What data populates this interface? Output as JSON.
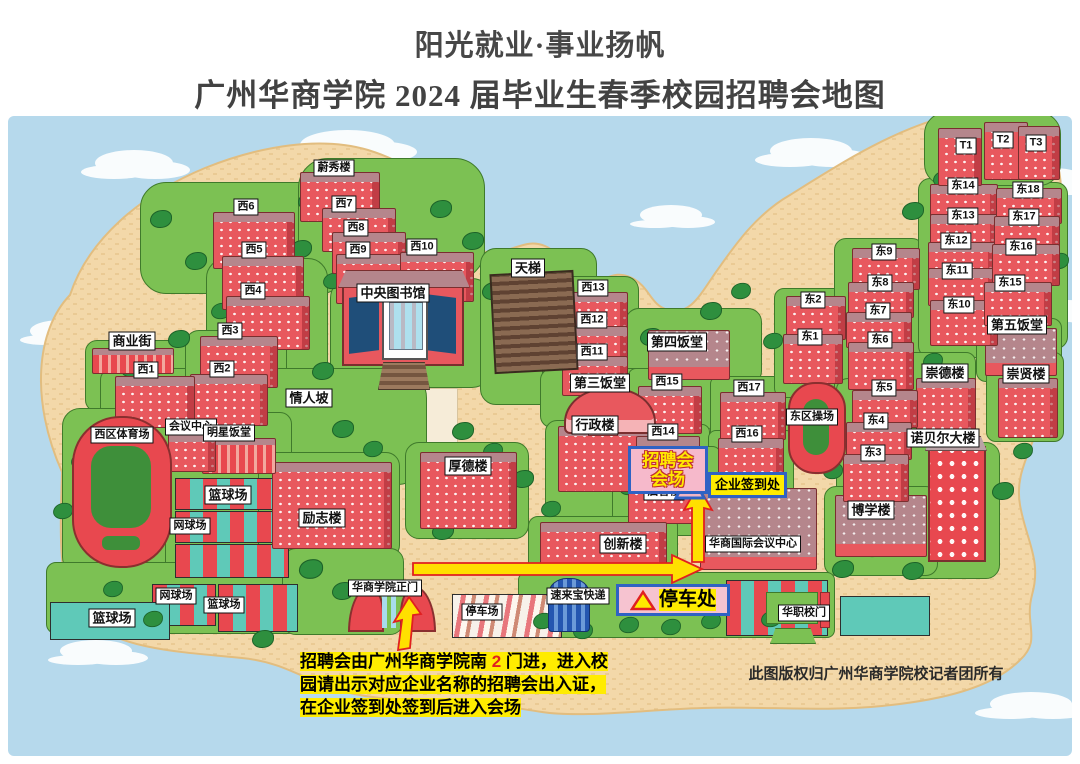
{
  "title": {
    "line1": "阳光就业·事业扬帆",
    "line2": "广州华商学院 2024 届毕业生春季校园招聘会地图"
  },
  "colors": {
    "sky_water": "#b6d9ec",
    "sand": "#f3d8a9",
    "sand_dash": "#e6c388",
    "green": "#7cc153",
    "tree": "#2e8f3e",
    "building_red": "#e8585e",
    "roof_mauve": "#b5868c",
    "court_teal": "#5fc9b8",
    "court_red": "#e8484f",
    "highlight_blue_border": "#2f62c4",
    "highlight_pink": "#f6b9cb",
    "highlight_yellow": "#ffec00",
    "arrow_yellow": "#ffe000",
    "arrow_red_outline": "#e02020"
  },
  "highlights": {
    "fair_venue": {
      "line1": "招聘会",
      "line2": "会场"
    },
    "sign_in": {
      "text": "企业签到处"
    },
    "parking": {
      "text": "停车处"
    }
  },
  "note": {
    "part1": "招聘会由广州华商学院南 ",
    "part2": "2",
    "part3": " 门进，进入校园请出示对应企业名称的招聘会出入证，在企业签到处签到后进入会场"
  },
  "copyright": "此图版权归广州华商学院校记者团所有",
  "map": {
    "labels": [
      {
        "t": "蔚秀楼",
        "x": 334,
        "y": 168
      },
      {
        "t": "西6",
        "x": 246,
        "y": 207
      },
      {
        "t": "西7",
        "x": 344,
        "y": 204
      },
      {
        "t": "西8",
        "x": 356,
        "y": 228
      },
      {
        "t": "西9",
        "x": 358,
        "y": 250
      },
      {
        "t": "西10",
        "x": 422,
        "y": 247
      },
      {
        "t": "西5",
        "x": 254,
        "y": 250
      },
      {
        "t": "西4",
        "x": 253,
        "y": 291
      },
      {
        "t": "西3",
        "x": 230,
        "y": 331
      },
      {
        "t": "西2",
        "x": 222,
        "y": 369
      },
      {
        "t": "西1",
        "x": 146,
        "y": 370
      },
      {
        "t": "商业街",
        "x": 132,
        "y": 341,
        "s": "md"
      },
      {
        "t": "中央图书馆",
        "x": 393,
        "y": 293,
        "s": "md"
      },
      {
        "t": "天梯",
        "x": 528,
        "y": 268,
        "s": "md"
      },
      {
        "t": "西13",
        "x": 593,
        "y": 288
      },
      {
        "t": "西12",
        "x": 592,
        "y": 320
      },
      {
        "t": "西11",
        "x": 592,
        "y": 352
      },
      {
        "t": "第四饭堂",
        "x": 677,
        "y": 342,
        "s": "md"
      },
      {
        "t": "第三饭堂",
        "x": 600,
        "y": 383,
        "s": "md"
      },
      {
        "t": "情人坡",
        "x": 309,
        "y": 398,
        "s": "md"
      },
      {
        "t": "西15",
        "x": 667,
        "y": 382
      },
      {
        "t": "西17",
        "x": 749,
        "y": 388
      },
      {
        "t": "西14",
        "x": 663,
        "y": 432
      },
      {
        "t": "西16",
        "x": 747,
        "y": 434
      },
      {
        "t": "东区操场",
        "x": 812,
        "y": 417
      },
      {
        "t": "会议中心",
        "x": 191,
        "y": 427
      },
      {
        "t": "明星饭堂",
        "x": 229,
        "y": 433
      },
      {
        "t": "西区体育场",
        "x": 122,
        "y": 435
      },
      {
        "t": "行政楼",
        "x": 595,
        "y": 425,
        "s": "md"
      },
      {
        "t": "厚德楼",
        "x": 468,
        "y": 466,
        "s": "md"
      },
      {
        "t": "启智楼",
        "x": 664,
        "y": 492
      },
      {
        "t": "励志楼",
        "x": 322,
        "y": 518,
        "s": "md"
      },
      {
        "t": "篮球场",
        "x": 228,
        "y": 495,
        "s": "md"
      },
      {
        "t": "网球场",
        "x": 190,
        "y": 526
      },
      {
        "t": "网球场",
        "x": 176,
        "y": 596
      },
      {
        "t": "篮球场",
        "x": 224,
        "y": 605
      },
      {
        "t": "篮球场",
        "x": 112,
        "y": 618,
        "s": "md"
      },
      {
        "t": "创新楼",
        "x": 623,
        "y": 544,
        "s": "md"
      },
      {
        "t": "华商国际会议中心",
        "x": 753,
        "y": 544
      },
      {
        "t": "华商学院正门",
        "x": 385,
        "y": 588
      },
      {
        "t": "停车场",
        "x": 482,
        "y": 612
      },
      {
        "t": "速来宝快递",
        "x": 578,
        "y": 596
      },
      {
        "t": "华职校门",
        "x": 804,
        "y": 613
      },
      {
        "t": "博学楼",
        "x": 871,
        "y": 510,
        "s": "md"
      },
      {
        "t": "诺贝尔大楼",
        "x": 943,
        "y": 438,
        "s": "md"
      },
      {
        "t": "崇德楼",
        "x": 945,
        "y": 373,
        "s": "md"
      },
      {
        "t": "崇贤楼",
        "x": 1026,
        "y": 374,
        "s": "md"
      },
      {
        "t": "第五饭堂",
        "x": 1017,
        "y": 325,
        "s": "md"
      },
      {
        "t": "东1",
        "x": 810,
        "y": 337
      },
      {
        "t": "东2",
        "x": 813,
        "y": 300
      },
      {
        "t": "东3",
        "x": 873,
        "y": 453
      },
      {
        "t": "东4",
        "x": 876,
        "y": 421
      },
      {
        "t": "东5",
        "x": 884,
        "y": 388
      },
      {
        "t": "东6",
        "x": 880,
        "y": 340
      },
      {
        "t": "东7",
        "x": 878,
        "y": 311
      },
      {
        "t": "东8",
        "x": 880,
        "y": 283
      },
      {
        "t": "东9",
        "x": 884,
        "y": 252
      },
      {
        "t": "东10",
        "x": 959,
        "y": 305
      },
      {
        "t": "东11",
        "x": 957,
        "y": 271
      },
      {
        "t": "东12",
        "x": 956,
        "y": 241
      },
      {
        "t": "东13",
        "x": 963,
        "y": 216
      },
      {
        "t": "东14",
        "x": 963,
        "y": 186
      },
      {
        "t": "东15",
        "x": 1010,
        "y": 283
      },
      {
        "t": "东16",
        "x": 1021,
        "y": 247
      },
      {
        "t": "东17",
        "x": 1024,
        "y": 217
      },
      {
        "t": "东18",
        "x": 1028,
        "y": 190
      },
      {
        "t": "T1",
        "x": 966,
        "y": 146
      },
      {
        "t": "T2",
        "x": 1003,
        "y": 140
      },
      {
        "t": "T3",
        "x": 1036,
        "y": 143
      }
    ],
    "clouds": [
      [
        95,
        150,
        78,
        26
      ],
      [
        300,
        130,
        95,
        30
      ],
      [
        640,
        205,
        62,
        20
      ],
      [
        770,
        138,
        82,
        26
      ],
      [
        1020,
        168,
        66,
        24
      ],
      [
        30,
        320,
        62,
        22
      ],
      [
        1042,
        300,
        52,
        20
      ],
      [
        60,
        640,
        72,
        22
      ],
      [
        990,
        692,
        82,
        24
      ]
    ],
    "greens": [
      [
        140,
        182,
        205,
        110,
        26
      ],
      [
        298,
        158,
        185,
        120,
        30
      ],
      [
        206,
        258,
        120,
        150,
        20
      ],
      [
        85,
        340,
        110,
        70,
        12
      ],
      [
        100,
        368,
        100,
        65,
        12
      ],
      [
        185,
        330,
        100,
        100,
        14
      ],
      [
        330,
        278,
        160,
        108,
        20
      ],
      [
        250,
        368,
        175,
        115,
        30
      ],
      [
        160,
        412,
        130,
        68,
        12
      ],
      [
        62,
        408,
        115,
        165,
        18
      ],
      [
        165,
        470,
        130,
        115,
        10
      ],
      [
        480,
        248,
        115,
        155,
        16
      ],
      [
        542,
        276,
        95,
        148,
        14
      ],
      [
        625,
        308,
        135,
        75,
        14
      ],
      [
        540,
        368,
        130,
        58,
        12
      ],
      [
        545,
        420,
        115,
        105,
        12
      ],
      [
        405,
        442,
        122,
        95,
        14
      ],
      [
        258,
        452,
        140,
        105,
        14
      ],
      [
        628,
        368,
        82,
        62,
        8
      ],
      [
        626,
        424,
        82,
        66,
        8
      ],
      [
        710,
        376,
        84,
        62,
        8
      ],
      [
        708,
        430,
        84,
        64,
        8
      ],
      [
        612,
        446,
        108,
        88,
        10
      ],
      [
        528,
        516,
        148,
        60,
        10
      ],
      [
        774,
        288,
        76,
        108,
        10
      ],
      [
        834,
        238,
        88,
        165,
        12
      ],
      [
        836,
        378,
        84,
        130,
        12
      ],
      [
        918,
        178,
        84,
        178,
        12
      ],
      [
        982,
        182,
        84,
        165,
        12
      ],
      [
        976,
        318,
        84,
        62,
        10
      ],
      [
        924,
        112,
        135,
        72,
        22
      ],
      [
        902,
        352,
        72,
        88,
        10
      ],
      [
        986,
        352,
        76,
        88,
        10
      ],
      [
        898,
        442,
        100,
        135,
        14
      ],
      [
        824,
        486,
        112,
        88,
        12
      ],
      [
        46,
        562,
        250,
        70,
        10
      ],
      [
        282,
        548,
        120,
        85,
        14
      ],
      [
        518,
        572,
        315,
        64,
        8
      ]
    ],
    "courts": [
      [
        175,
        478,
        112,
        30,
        "grid"
      ],
      [
        175,
        511,
        112,
        30,
        "grid"
      ],
      [
        175,
        544,
        112,
        32,
        "grid"
      ],
      [
        152,
        584,
        62,
        40,
        "grid"
      ],
      [
        218,
        584,
        78,
        46,
        "grid"
      ],
      [
        50,
        602,
        118,
        36,
        "teal"
      ],
      [
        452,
        594,
        108,
        42,
        "stripe"
      ],
      [
        726,
        580,
        100,
        54,
        "grid"
      ],
      [
        840,
        596,
        88,
        38,
        "teal"
      ]
    ],
    "buildings": [
      [
        300,
        172,
        78,
        48,
        "r"
      ],
      [
        322,
        208,
        72,
        42,
        "r"
      ],
      [
        332,
        232,
        72,
        40,
        "r"
      ],
      [
        336,
        254,
        76,
        48,
        "r"
      ],
      [
        400,
        252,
        72,
        48,
        "r"
      ],
      [
        213,
        212,
        80,
        55,
        "r"
      ],
      [
        222,
        256,
        80,
        52,
        "r"
      ],
      [
        226,
        296,
        82,
        52,
        "r"
      ],
      [
        200,
        336,
        76,
        50,
        "r"
      ],
      [
        190,
        374,
        76,
        50,
        "r"
      ],
      [
        115,
        376,
        78,
        50,
        "r"
      ],
      [
        92,
        348,
        80,
        24,
        "s"
      ],
      [
        562,
        292,
        64,
        40,
        "r"
      ],
      [
        562,
        326,
        64,
        36,
        "r"
      ],
      [
        562,
        356,
        64,
        38,
        "r"
      ],
      [
        648,
        330,
        80,
        48,
        "m"
      ],
      [
        558,
        426,
        90,
        64,
        "r"
      ],
      [
        638,
        386,
        62,
        46,
        "r"
      ],
      [
        720,
        392,
        64,
        46,
        "r"
      ],
      [
        636,
        436,
        62,
        48,
        "r"
      ],
      [
        718,
        438,
        64,
        48,
        "r"
      ],
      [
        628,
        476,
        84,
        46,
        "r"
      ],
      [
        420,
        452,
        95,
        75,
        "r"
      ],
      [
        272,
        462,
        118,
        85,
        "r"
      ],
      [
        540,
        522,
        125,
        46,
        "r"
      ],
      [
        700,
        488,
        115,
        80,
        "m"
      ],
      [
        835,
        495,
        90,
        60,
        "m"
      ],
      [
        916,
        378,
        58,
        58,
        "r"
      ],
      [
        998,
        378,
        58,
        58,
        "r"
      ],
      [
        985,
        328,
        70,
        46,
        "m"
      ],
      [
        786,
        296,
        58,
        42,
        "r"
      ],
      [
        783,
        334,
        58,
        48,
        "r"
      ],
      [
        852,
        248,
        66,
        40,
        "r"
      ],
      [
        848,
        282,
        64,
        34,
        "r"
      ],
      [
        846,
        312,
        64,
        34,
        "r"
      ],
      [
        848,
        342,
        64,
        46,
        "r"
      ],
      [
        852,
        390,
        64,
        36,
        "r"
      ],
      [
        846,
        422,
        64,
        36,
        "r"
      ],
      [
        843,
        454,
        64,
        46,
        "r"
      ],
      [
        930,
        184,
        66,
        36,
        "r"
      ],
      [
        930,
        214,
        66,
        32,
        "r"
      ],
      [
        928,
        242,
        66,
        32,
        "r"
      ],
      [
        928,
        268,
        66,
        36,
        "r"
      ],
      [
        930,
        300,
        66,
        44,
        "r"
      ],
      [
        996,
        188,
        64,
        34,
        "r"
      ],
      [
        994,
        216,
        64,
        32,
        "r"
      ],
      [
        992,
        244,
        66,
        40,
        "r"
      ],
      [
        984,
        282,
        66,
        42,
        "r"
      ],
      [
        938,
        128,
        42,
        56,
        "r"
      ],
      [
        984,
        122,
        42,
        56,
        "r"
      ],
      [
        1018,
        126,
        40,
        52,
        "r"
      ],
      [
        202,
        438,
        72,
        34,
        "s"
      ],
      [
        168,
        432,
        46,
        38,
        "r"
      ]
    ],
    "trees": [
      [
        150,
        210,
        1
      ],
      [
        185,
        252,
        1
      ],
      [
        210,
        302,
        0.9
      ],
      [
        168,
        330,
        1
      ],
      [
        120,
        360,
        0.9
      ],
      [
        298,
        192,
        1
      ],
      [
        290,
        240,
        1
      ],
      [
        322,
        272,
        0.9
      ],
      [
        430,
        200,
        1
      ],
      [
        462,
        232,
        1
      ],
      [
        482,
        282,
        1
      ],
      [
        520,
        302,
        0.9
      ],
      [
        558,
        322,
        0.9
      ],
      [
        640,
        328,
        1
      ],
      [
        700,
        302,
        1
      ],
      [
        730,
        282,
        0.9
      ],
      [
        312,
        362,
        1
      ],
      [
        332,
        420,
        1
      ],
      [
        362,
        440,
        0.9
      ],
      [
        252,
        452,
        1
      ],
      [
        452,
        422,
        1
      ],
      [
        482,
        442,
        0.9
      ],
      [
        512,
        470,
        1
      ],
      [
        540,
        500,
        0.9
      ],
      [
        432,
        522,
        1
      ],
      [
        300,
        560,
        1.1
      ],
      [
        332,
        582,
        1
      ],
      [
        102,
        580,
        0.9
      ],
      [
        142,
        610,
        0.9
      ],
      [
        252,
        630,
        1
      ],
      [
        532,
        612,
        0.9
      ],
      [
        572,
        622,
        0.9
      ],
      [
        618,
        616,
        0.9
      ],
      [
        660,
        618,
        0.9
      ],
      [
        700,
        612,
        0.9
      ],
      [
        760,
        610,
        0.9
      ],
      [
        832,
        560,
        1
      ],
      [
        862,
        540,
        0.9
      ],
      [
        902,
        562,
        1
      ],
      [
        942,
        522,
        1.1
      ],
      [
        992,
        482,
        1
      ],
      [
        1012,
        442,
        0.9
      ],
      [
        872,
        482,
        0.9
      ],
      [
        822,
        462,
        0.9
      ],
      [
        792,
        352,
        0.9
      ],
      [
        762,
        332,
        0.9
      ],
      [
        922,
        352,
        0.9
      ],
      [
        1002,
        350,
        0.9
      ],
      [
        952,
        300,
        0.9
      ],
      [
        902,
        202,
        1
      ],
      [
        932,
        170,
        0.9
      ],
      [
        1048,
        252,
        0.9
      ],
      [
        70,
        452,
        0.9
      ],
      [
        52,
        502,
        0.9
      ],
      [
        618,
        478,
        0.9
      ],
      [
        718,
        472,
        0.9
      ]
    ]
  }
}
